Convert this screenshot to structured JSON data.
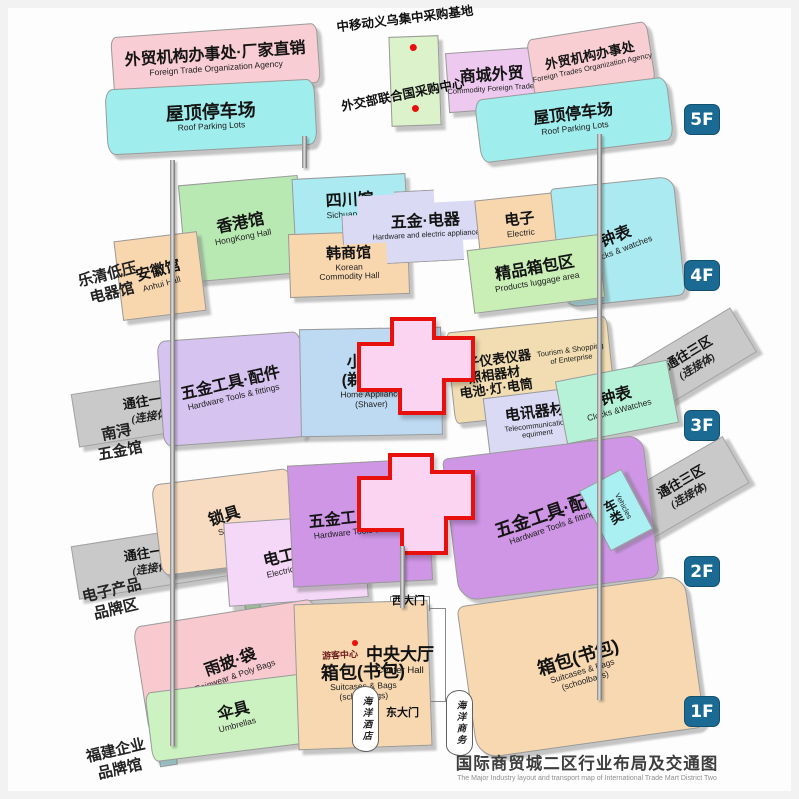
{
  "page_title": {
    "zh": "国际商贸城二区行业布局及交通图",
    "en": "The Major Industry layout and transport map of International Trade Mart District Two"
  },
  "landmarks": {
    "cm_base": "中移动义乌集中采购基地",
    "un_center": "外交部联合国采购中心",
    "visitor_center": "游客中心",
    "west_gate": "西大门",
    "east_gate": "东大门",
    "ocean_hotel": "海洋酒店",
    "ocean_business": "海洋商务",
    "center_hall": {
      "zh": "中央大厅",
      "en": "Center Hall"
    }
  },
  "side_labels": {
    "yueqing": {
      "line1": "乐清低压",
      "line2": "电器馆"
    },
    "nanxun": {
      "line1": "南浔",
      "line2": "五金馆"
    },
    "ebrand": {
      "line1": "电子产品",
      "line2": "品牌区"
    },
    "fujian": {
      "line1": "福建企业",
      "line2": "品牌馆"
    }
  },
  "floors": {
    "f5": {
      "badge": "5F",
      "left_office": {
        "zh": "外贸机构办事处·厂家直销",
        "en": "Foreign Trade Organization Agency"
      },
      "left_parking": {
        "zh": "屋顶停车场",
        "en": "Roof Parking Lots"
      },
      "mall_trade": {
        "zh": "商城外贸",
        "en": "Commodity Foreign Trades"
      },
      "right_office": {
        "zh": "外贸机构办事处",
        "en": "Foreign Trades Organization Agency"
      },
      "right_parking": {
        "zh": "屋顶停车场",
        "en": "Roof Parking Lots"
      }
    },
    "f4": {
      "badge": "4F",
      "hongkong": {
        "zh": "香港馆",
        "en": "HongKong Hall"
      },
      "sichuan": {
        "zh": "四川馆",
        "en": "Sichuan Hall"
      },
      "anhui": {
        "zh": "安徽馆",
        "en": "Anhui Hall"
      },
      "korean": {
        "zh": "韩商馆",
        "en": "Korean",
        "en2": "Commodity Hall"
      },
      "hardware_electric": {
        "zh": "五金·电器",
        "en": "Hardware and electric appliance"
      },
      "electric": {
        "zh": "电子",
        "en": "Electric"
      },
      "clocks": {
        "zh": "钟表",
        "en": "Clocks & watches"
      },
      "luggage": {
        "zh": "精品箱包区",
        "en": "Products luggage area"
      }
    },
    "f3": {
      "badge": "3F",
      "ramp_left": {
        "zh": "通往一区",
        "zh2": "(连接体)"
      },
      "tools": {
        "zh": "五金工具·配件",
        "en": "Hardware Tools & fittings"
      },
      "appliance": {
        "zh": "小家电",
        "zh2": "(剃须刀)",
        "en": "Home Appliance",
        "en2": "(Shaver)"
      },
      "instruments": {
        "zh": "电子仪表仪器",
        "zh2": "照相器材",
        "zh3": "电池·灯·电筒",
        "en": "Tourism & Shopping",
        "en2": "of Enterprise"
      },
      "telecom": {
        "zh": "电讯器材",
        "en": "Telecommunication",
        "en2": "equiment"
      },
      "clocks": {
        "zh": "钟表",
        "en": "Clocks &Watches"
      },
      "ramp_right": {
        "zh": "通往三区",
        "zh2": "(连接体)"
      }
    },
    "f2": {
      "badge": "2F",
      "ramp_left": {
        "zh": "通往一区",
        "zh2": "(连接体)"
      },
      "locks": {
        "zh": "锁具",
        "en": "Stock"
      },
      "electric_products": {
        "zh": "电工产品",
        "en": "Electric Products"
      },
      "tools_center": {
        "zh": "五金工具·配件",
        "en": "Hardware Tools & fittings"
      },
      "tools_right": {
        "zh": "五金工具·配件",
        "en": "Hardware Tools & fittings"
      },
      "vehicles": {
        "zh": "车类",
        "en": "Vehicles"
      },
      "ramp_right": {
        "zh": "通往三区",
        "zh2": "(连接体)"
      }
    },
    "f1": {
      "badge": "1F",
      "rainwear": {
        "zh": "雨披·袋",
        "en": "Rainwear & Poly Bags"
      },
      "umbrellas": {
        "zh": "伞具",
        "en": "Umbrellas"
      },
      "bags_left": {
        "zh": "箱包(书包)",
        "en": "Suitcases & Bags",
        "en2": "(schoolbags)"
      },
      "bags_right": {
        "zh": "箱包(书包)",
        "en": "Suitcases & Bags",
        "en2": "(schoolbags)"
      }
    }
  },
  "colors": {
    "badge_blue": "#1a6a93",
    "cross_fill": "#fbd4f1",
    "cross_border": "#e8100c",
    "parking_cyan": "#a0edee",
    "office_pink": "#f8cdd3",
    "tools_purple": "#ce96e5"
  }
}
